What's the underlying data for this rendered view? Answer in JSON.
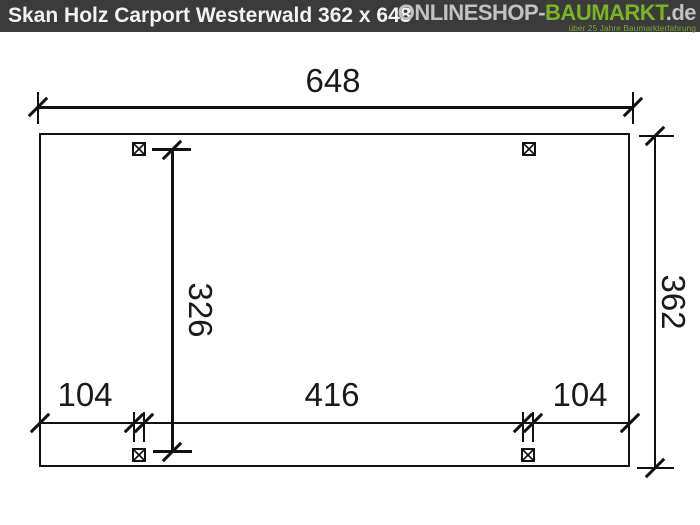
{
  "header": {
    "title": "Skan Holz Carport Westerwald 362 x 648",
    "logo": {
      "part1": "ONLINESHOP-",
      "part2": "BAUMARKT",
      "part3": ".de",
      "tagline": "über 25 Jahre Baumarkterfahrung"
    },
    "colors": {
      "bar_bg": "#3b3b3b",
      "title_text": "#f2f2f2",
      "logo_gray": "#c2c2c2",
      "logo_green": "#7cb325"
    }
  },
  "drawing": {
    "type": "dimension-diagram",
    "subject": "carport footprint plan, top view",
    "line_color": "#111111",
    "dimensions": {
      "width_total": "648",
      "depth_total": "362",
      "inner_depth": "326",
      "bottom_left": "104",
      "bottom_center": "416",
      "bottom_right": "104"
    },
    "posts_count": 4
  }
}
